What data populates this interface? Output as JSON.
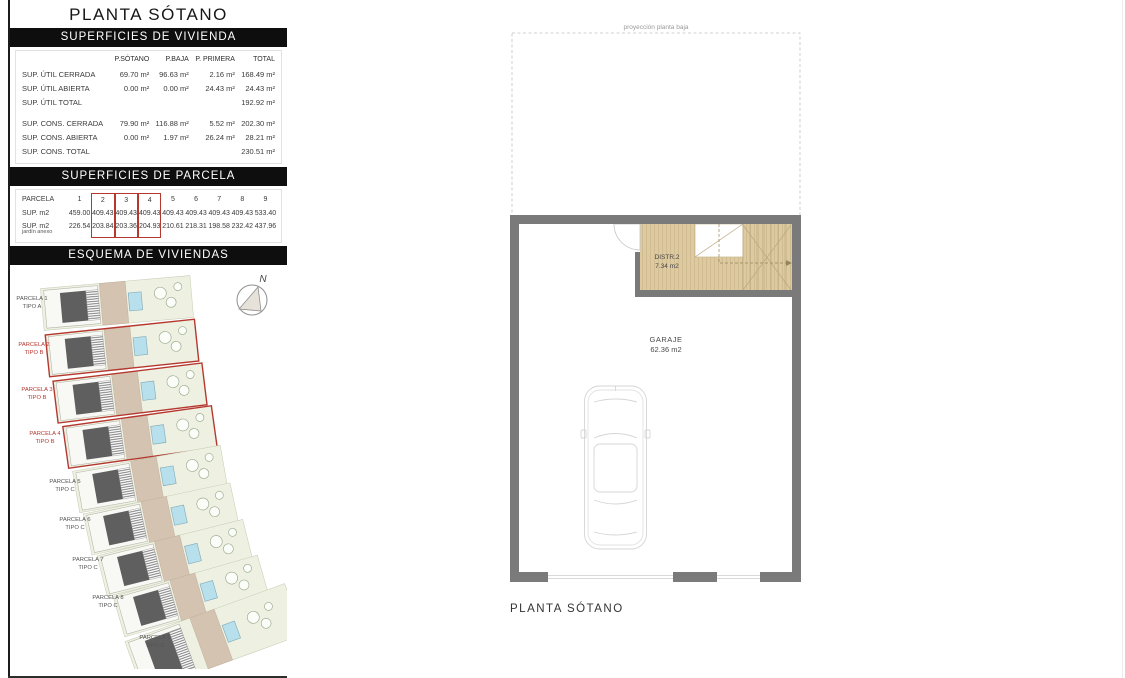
{
  "page": {
    "title": "PLANTA SÓTANO"
  },
  "vivienda": {
    "header": "SUPERFICIES DE VIVIENDA",
    "columns": [
      "",
      "P.SÓTANO",
      "P.BAJA",
      "P. PRIMERA",
      "TOTAL"
    ],
    "rows": [
      {
        "label": "SUP. ÚTIL CERRADA",
        "values": [
          "69.70 m²",
          "96.63 m²",
          "2.16 m²",
          "168.49 m²"
        ]
      },
      {
        "label": "SUP. ÚTIL ABIERTA",
        "values": [
          "0.00 m²",
          "0.00 m²",
          "24.43 m²",
          "24.43 m²"
        ]
      },
      {
        "label": "SUP. ÚTIL TOTAL",
        "values": [
          "",
          "",
          "",
          "192.92 m²"
        ]
      },
      {
        "label": "SUP. CONS. CERRADA",
        "values": [
          "79.90 m²",
          "116.88 m²",
          "5.52 m²",
          "202.30 m²"
        ]
      },
      {
        "label": "SUP. CONS. ABIERTA",
        "values": [
          "0.00 m²",
          "1.97 m²",
          "26.24 m²",
          "28.21 m²"
        ]
      },
      {
        "label": "SUP. CONS. TOTAL",
        "values": [
          "",
          "",
          "",
          "230.51 m²"
        ]
      }
    ]
  },
  "parcela": {
    "header": "SUPERFICIES DE PARCELA",
    "row_labels": {
      "r1": "PARCELA",
      "r2": "SUP. m2",
      "r3a": "SUP. m2",
      "r3b": "jardín anexo"
    },
    "numbers": [
      "1",
      "2",
      "3",
      "4",
      "5",
      "6",
      "7",
      "8",
      "9"
    ],
    "sup": [
      "459.00",
      "409.43",
      "409.43",
      "409.43",
      "409.43",
      "409.43",
      "409.43",
      "409.43",
      "533.40"
    ],
    "jardin": [
      "226.54",
      "203.84",
      "203.36",
      "204.93",
      "210.61",
      "218.31",
      "198.58",
      "232.42",
      "437.96"
    ],
    "highlighted": [
      2,
      3,
      4
    ]
  },
  "esquema": {
    "header": "ESQUEMA DE VIVIENDAS",
    "north_label": "N",
    "parcels": [
      {
        "name": "PARCELA 1",
        "tipo": "TIPO A",
        "highlight": false
      },
      {
        "name": "PARCELA 2",
        "tipo": "TIPO B",
        "highlight": true
      },
      {
        "name": "PARCELA 3",
        "tipo": "TIPO B",
        "highlight": true
      },
      {
        "name": "PARCELA 4",
        "tipo": "TIPO B",
        "highlight": true
      },
      {
        "name": "PARCELA 5",
        "tipo": "TIPO C",
        "highlight": false
      },
      {
        "name": "PARCELA 6",
        "tipo": "TIPO C",
        "highlight": false
      },
      {
        "name": "PARCELA 7",
        "tipo": "TIPO C",
        "highlight": false
      },
      {
        "name": "PARCELA 8",
        "tipo": "TIPO C",
        "highlight": false
      },
      {
        "name": "PARCELA 9",
        "tipo": "TIPO D",
        "highlight": false
      }
    ]
  },
  "plan": {
    "projection_label": "proyección planta baja",
    "distr_name": "DISTR.2",
    "distr_area": "7.34 m2",
    "garage_name": "GARAJE",
    "garage_area": "62.36 m2",
    "caption": "PLANTA SÓTANO"
  },
  "colors": {
    "accent_red": "#b5382f",
    "bar_black": "#0e0e0e",
    "wall_gray": "#7a7a7a",
    "floor_tan": "#ddcaa1",
    "pool_blue": "#b7e0ec",
    "lawn_green": "#eef1e2",
    "roof_gray": "#5f5f5f",
    "terrace_beige": "#d3c3b0"
  }
}
